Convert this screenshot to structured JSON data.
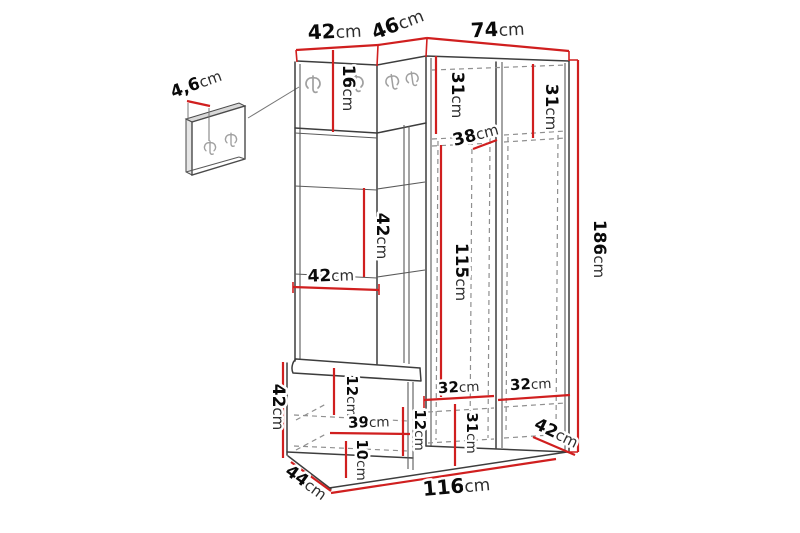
{
  "diagram": {
    "dims": {
      "panel_thickness": {
        "value": "4,6",
        "unit": "cm"
      },
      "top_left_width": {
        "value": "42",
        "unit": "cm"
      },
      "top_corner_width": {
        "value": "46",
        "unit": "cm"
      },
      "top_right_width": {
        "value": "74",
        "unit": "cm"
      },
      "hook_strip_height": {
        "value": "16",
        "unit": "cm"
      },
      "left_door_top_space": {
        "value": "31",
        "unit": "cm"
      },
      "right_door_top_space": {
        "value": "31",
        "unit": "cm"
      },
      "shelf_depth": {
        "value": "38",
        "unit": "cm"
      },
      "left_section_gap": {
        "value": "42",
        "unit": "cm"
      },
      "left_section_width": {
        "value": "42",
        "unit": "cm"
      },
      "interior_height": {
        "value": "115",
        "unit": "cm"
      },
      "total_height": {
        "value": "186",
        "unit": "cm"
      },
      "left_shelf_width": {
        "value": "32",
        "unit": "cm"
      },
      "right_shelf_width": {
        "value": "32",
        "unit": "cm"
      },
      "bottom_space_height": {
        "value": "31",
        "unit": "cm"
      },
      "corner_filler_width": {
        "value": "12",
        "unit": "cm"
      },
      "bench_top_thickness": {
        "value": "12",
        "unit": "cm"
      },
      "bench_inner_width": {
        "value": "39",
        "unit": "cm"
      },
      "bench_bottom_height": {
        "value": "10",
        "unit": "cm"
      },
      "bench_height": {
        "value": "42",
        "unit": "cm"
      },
      "bench_depth": {
        "value": "44",
        "unit": "cm"
      },
      "wardrobe_depth": {
        "value": "42",
        "unit": "cm"
      },
      "total_width": {
        "value": "116",
        "unit": "cm"
      }
    }
  }
}
